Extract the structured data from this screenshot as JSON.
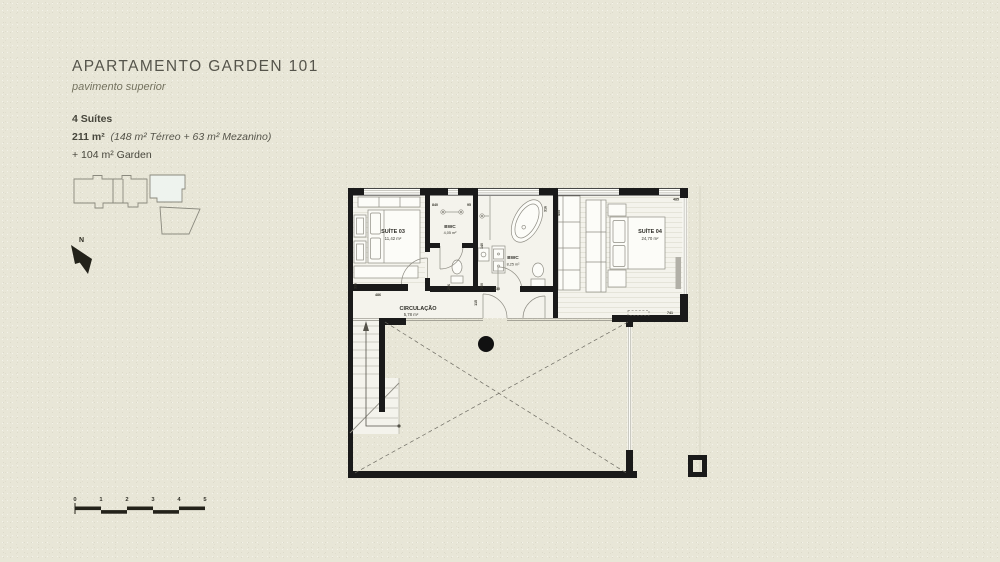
{
  "header": {
    "title": "APARTAMENTO GARDEN 101",
    "subtitle": "pavimento superior",
    "specs": {
      "suites": "4 Suítes",
      "area_total": "211 m²",
      "area_note": "(148 m² Térreo + 63 m² Mezanino)",
      "garden": "+ 104 m² Garden"
    }
  },
  "north": {
    "label": "N"
  },
  "plan": {
    "rooms": {
      "suite03": {
        "name": "SUÍTE 03",
        "area": "11,42 m²"
      },
      "bwc03": {
        "name": "BWC",
        "area": "4,05 m²"
      },
      "bwc04": {
        "name": "BWC",
        "area": "8,25 m²"
      },
      "suite04": {
        "name": "SUÍTE 04",
        "area": "24,70 m²"
      },
      "circulacao": {
        "name": "CIRCULAÇÃO",
        "area": "5,78 m²"
      }
    },
    "dims": {
      "d840": "840",
      "d95": "95",
      "d316": "316",
      "d455": "455",
      "d485": "485",
      "d140": "140",
      "d200": "200",
      "d230": "230",
      "d206": "206",
      "d336": "336",
      "d486": "486",
      "d115": "115",
      "d741": "741"
    }
  },
  "scalebar": {
    "labels": [
      "0",
      "1",
      "2",
      "3",
      "4",
      "5"
    ]
  },
  "colors": {
    "background": "#e8e6d7",
    "floor": "#f4f3ec",
    "wall": "#181818",
    "line": "#8f8d84",
    "highlight_unit": "#eef3ee"
  }
}
